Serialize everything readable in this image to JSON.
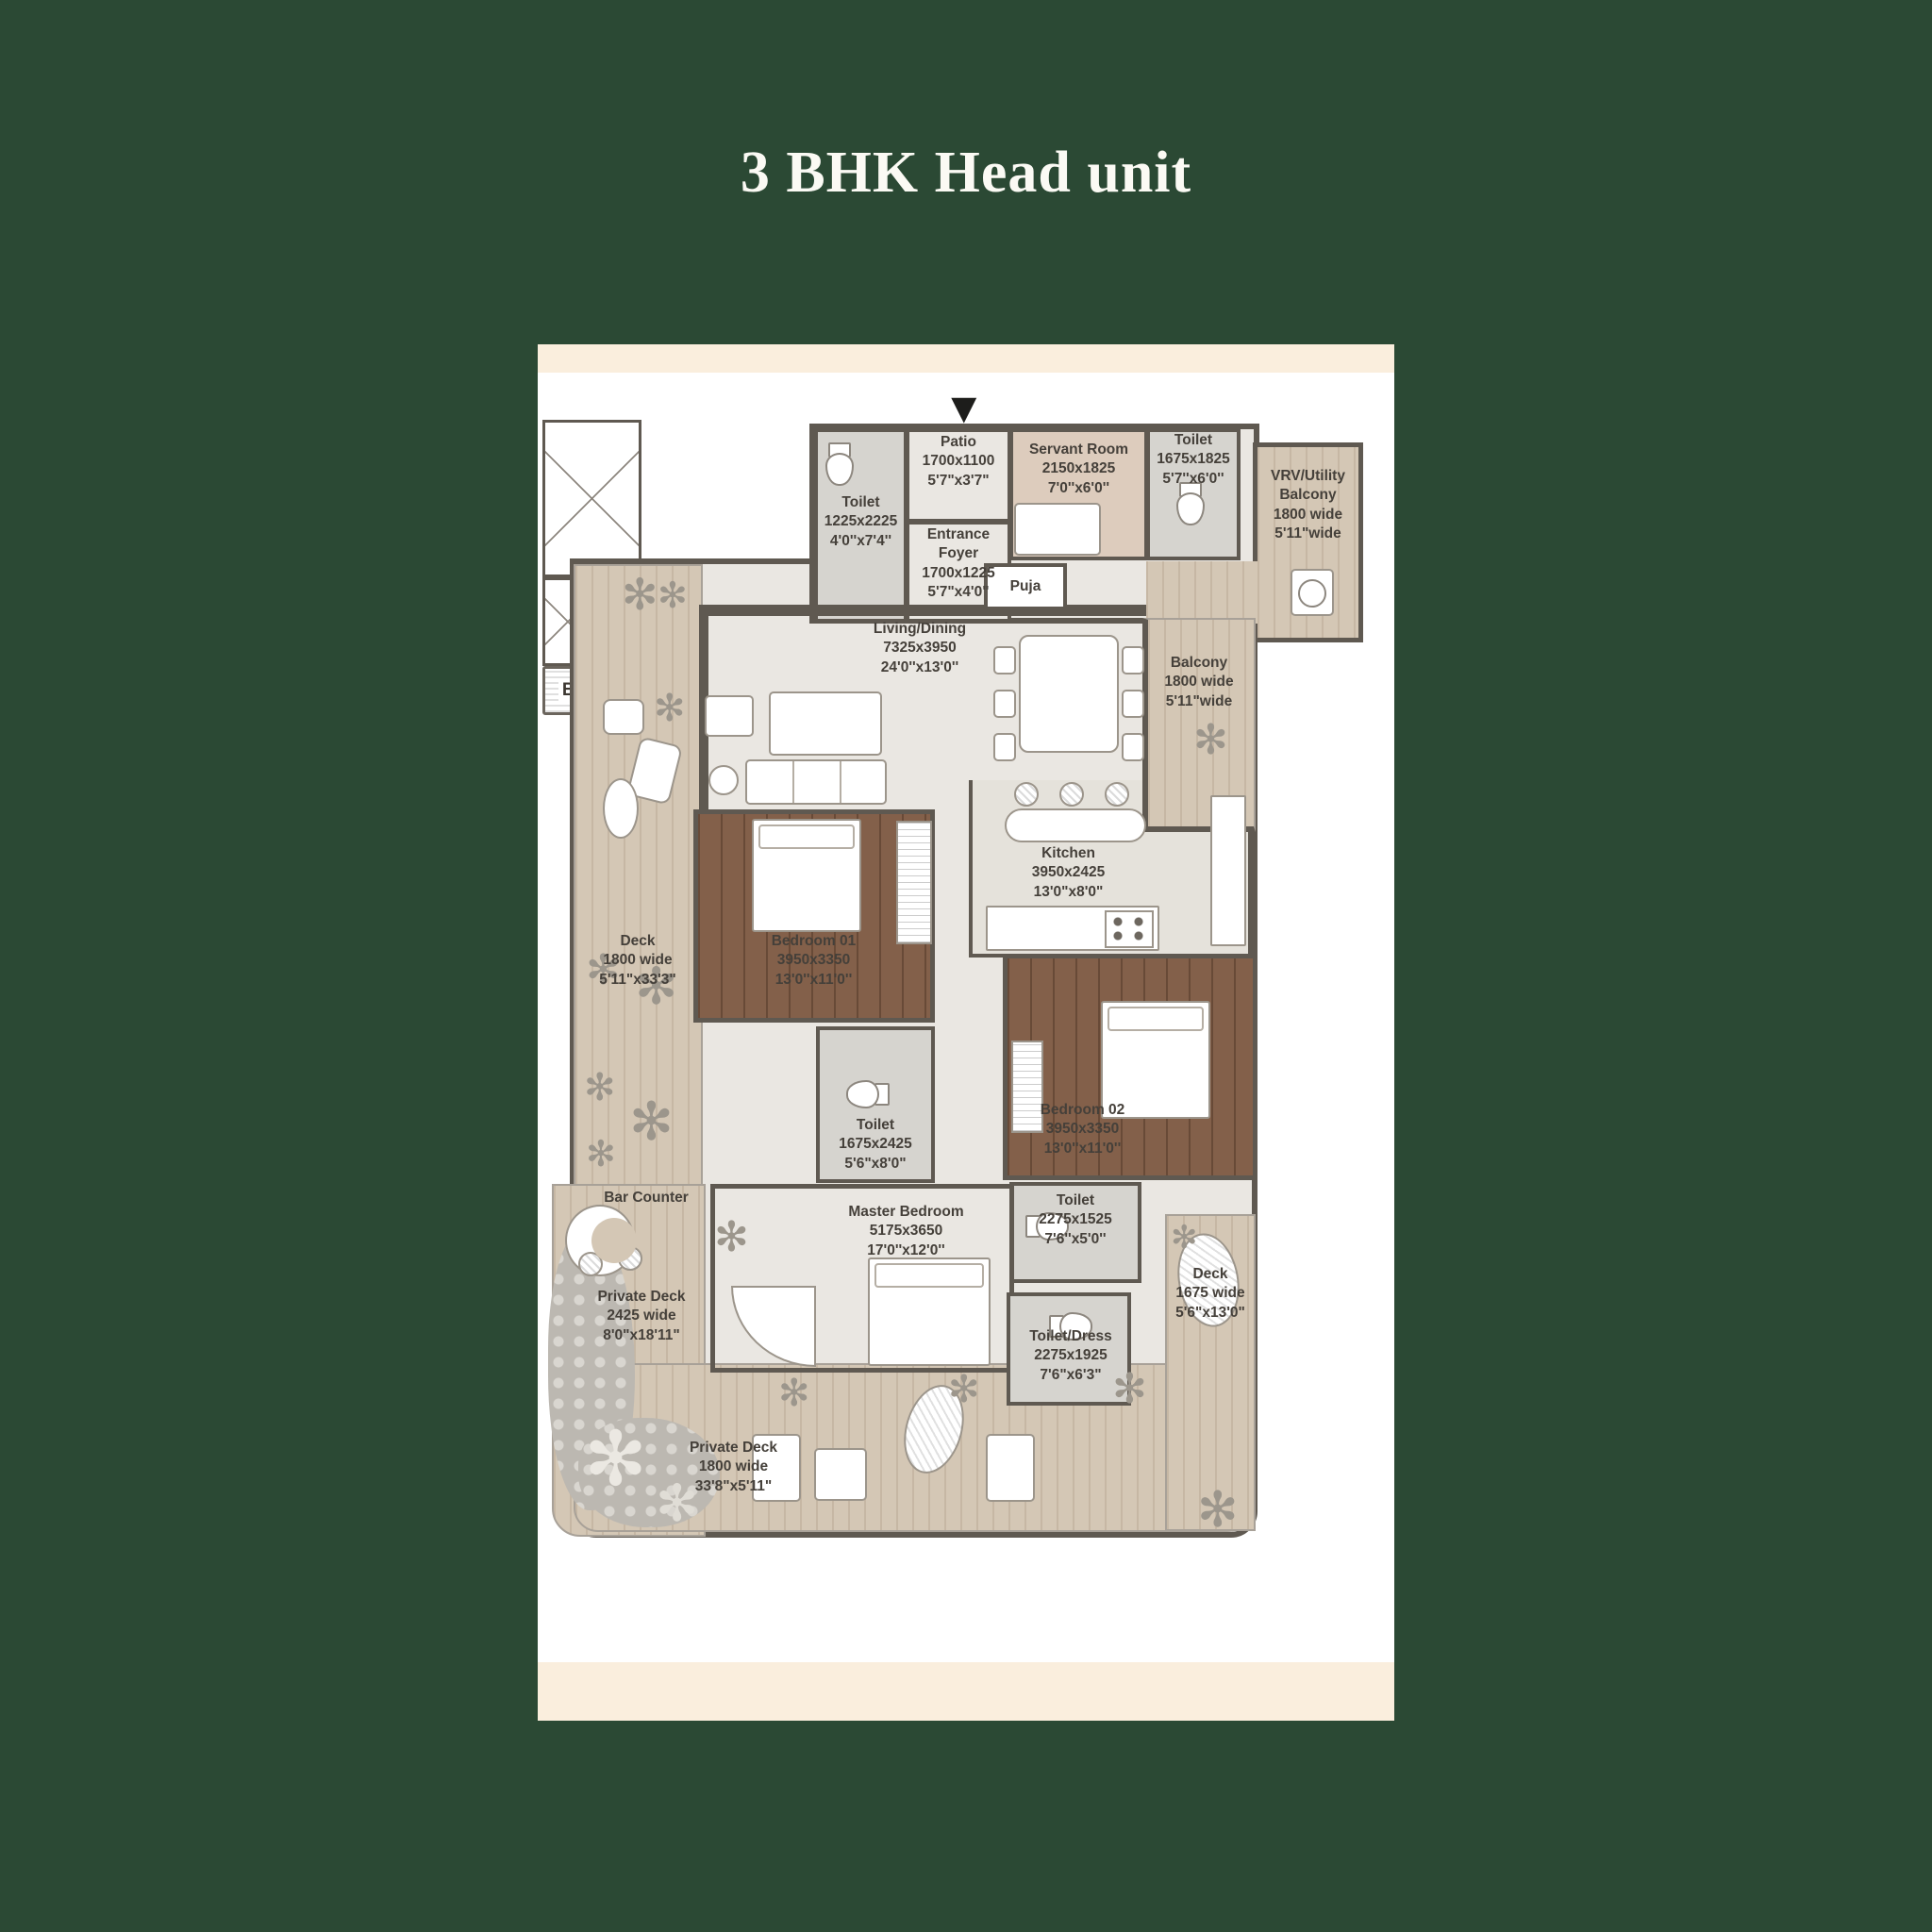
{
  "title": "3 BHK Head unit",
  "colors": {
    "background": "#2b4934",
    "panel": "#ffffff",
    "panel_band": "#faeedd",
    "wall": "#5f5951",
    "label_text": "#45403a"
  },
  "icons": {
    "plant": "✻",
    "entrance_arrow": "▼"
  },
  "rooms": {
    "toilet_entry": {
      "line1": "Toilet",
      "line2": "1225x2225",
      "line3": "4'0''x7'4''"
    },
    "patio": {
      "line1": "Patio",
      "line2": "1700x1100",
      "line3": "5'7\"x3'7\""
    },
    "entrance_foyer": {
      "line1": "Entrance Foyer",
      "line2": "1700x1225",
      "line3": "5'7\"x4'0\""
    },
    "servant_room": {
      "line1": "Servant Room",
      "line2": "2150x1825",
      "line3": "7'0''x6'0''"
    },
    "toilet_servant": {
      "line1": "Toilet",
      "line2": "1675x1825",
      "line3": "5'7''x6'0''"
    },
    "vrv_utility_balcony": {
      "line1": "VRV/Utility Balcony",
      "line2": "1800 wide",
      "line3": "5'11\"wide"
    },
    "puja": {
      "line1": "Puja"
    },
    "living_dining": {
      "line1": "Living/Dining",
      "line2": "7325x3950",
      "line3": "24'0''x13'0''"
    },
    "balcony": {
      "line1": "Balcony",
      "line2": "1800 wide",
      "line3": "5'11\"wide"
    },
    "bbq": {
      "line1": "BBQ"
    },
    "deck_left": {
      "line1": "Deck",
      "line2": "1800 wide",
      "line3": "5'11\"x33'3\""
    },
    "kitchen": {
      "line1": "Kitchen",
      "line2": "3950x2425",
      "line3": "13'0\"x8'0\""
    },
    "bedroom_01": {
      "line1": "Bedroom 01",
      "line2": "3950x3350",
      "line3": "13'0''x11'0''"
    },
    "toilet_bedroom_01": {
      "line1": "Toilet",
      "line2": "1675x2425",
      "line3": "5'6\"x8'0\""
    },
    "bedroom_02": {
      "line1": "Bedroom 02",
      "line2": "3950x3350",
      "line3": "13'0''x11'0''"
    },
    "toilet_bedroom_02": {
      "line1": "Toilet",
      "line2": "2275x1525",
      "line3": "7'6''x5'0''"
    },
    "bar_counter": {
      "line1": "Bar Counter"
    },
    "master_bedroom": {
      "line1": "Master Bedroom",
      "line2": "5175x3650",
      "line3": "17'0''x12'0''"
    },
    "private_deck_left": {
      "line1": "Private Deck",
      "line2": "2425 wide",
      "line3": "8'0\"x18'11\""
    },
    "toilet_dress": {
      "line1": "Toilet/Dress",
      "line2": "2275x1925",
      "line3": "7'6\"x6'3\""
    },
    "deck_right": {
      "line1": "Deck",
      "line2": "1675 wide",
      "line3": "5'6\"x13'0\""
    },
    "private_deck_bottom": {
      "line1": "Private Deck",
      "line2": "1800 wide",
      "line3": "33'8\"x5'11\""
    }
  }
}
